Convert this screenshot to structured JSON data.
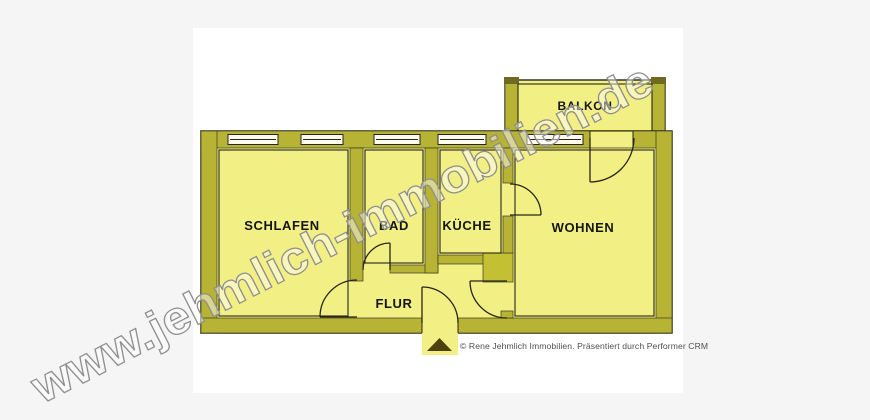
{
  "watermark": {
    "text": "www.jehmlich-immobilien.de"
  },
  "floorplan": {
    "type": "apartment-floor-plan",
    "rooms": [
      {
        "id": "schlafen",
        "label": "SCHLAFEN"
      },
      {
        "id": "bad",
        "label": "BAD"
      },
      {
        "id": "kueche",
        "label": "KÜCHE"
      },
      {
        "id": "wohnen",
        "label": "WOHNEN"
      },
      {
        "id": "flur",
        "label": "FLUR"
      },
      {
        "id": "balkon",
        "label": "BALKON"
      }
    ],
    "colors": {
      "room_fill": "#f2ef85",
      "wall_fill": "#b7b335",
      "line": "#26261a",
      "window_fill": "#fcfbee",
      "page_background": "#f5f5f5",
      "scan_background": "#ffffff",
      "logo_triangle": "#4c420f",
      "watermark_outline": "#8f8f8f"
    }
  },
  "footer": {
    "credit": "© Rene Jehmlich Immobilien. Präsentiert durch Performer CRM",
    "logo": "triangle-logo"
  }
}
